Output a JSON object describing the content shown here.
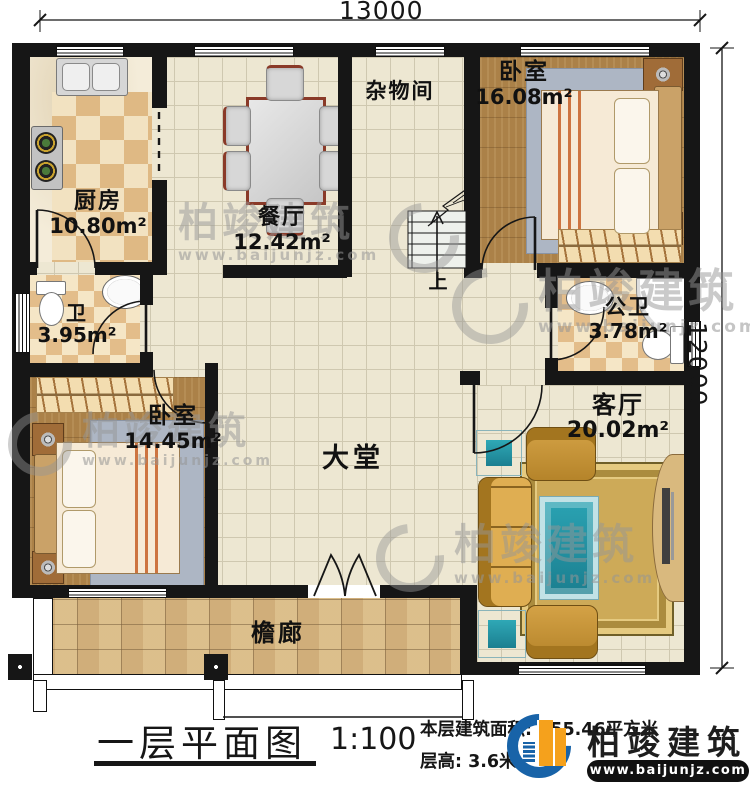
{
  "dimensions": {
    "top": "13000",
    "right": "12000"
  },
  "rooms": [
    {
      "name": "厨房",
      "area": "10.80m²"
    },
    {
      "name": "餐厅",
      "area": "12.42m²"
    },
    {
      "name": "杂物间",
      "area": ""
    },
    {
      "name": "卧室",
      "area": "16.08m²"
    },
    {
      "name": "卫",
      "area": "3.95m²"
    },
    {
      "name": "公卫",
      "area": "3.78m²"
    },
    {
      "name": "客厅",
      "area": "20.02m²"
    },
    {
      "name": "卧室",
      "area": "14.45m²"
    },
    {
      "name": "大堂",
      "area": ""
    },
    {
      "name": "檐廊",
      "area": ""
    }
  ],
  "stairs": {
    "up_label": "上"
  },
  "title_block": {
    "title": "一层平面图",
    "scale": "1:100",
    "area_label": "本层建筑面积:",
    "area_value": "155.46平方米",
    "height_label": "层高:",
    "height_value": "3.6米"
  },
  "brand": {
    "name": "柏竣建筑",
    "website": "www.baijunjz.com"
  },
  "watermark": {
    "name": "柏竣建筑",
    "website": "www.baijunjz.com"
  },
  "colors": {
    "wall": "#161616",
    "logo_blue": "#1863a8",
    "logo_orange": "#f5a11c",
    "wood": "#ab8148",
    "tile_beige": "#ede7d2",
    "checker_tan": "#dfb984",
    "stone": "#d8bc8b",
    "rug_gold": "#cdaa58",
    "sofa_gold": "#c08a30",
    "teal": "#2fa8b6"
  }
}
